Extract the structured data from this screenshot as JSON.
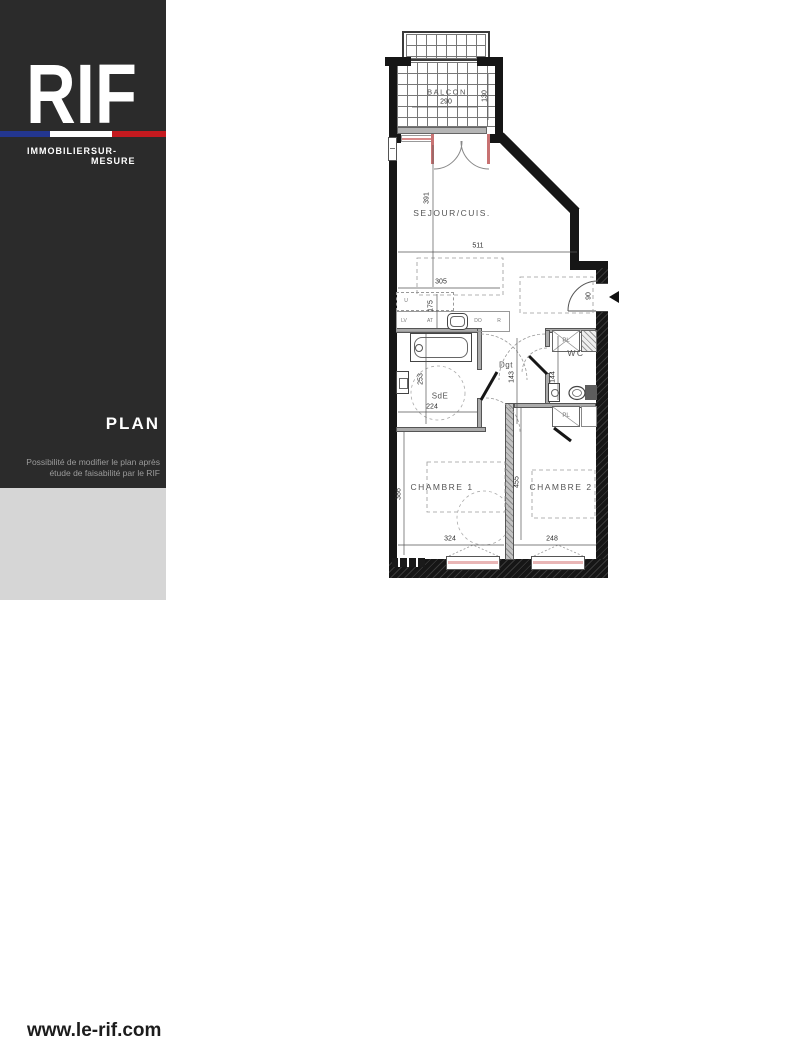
{
  "sidebar": {
    "logo": "RIF",
    "tagline_left": "IMMOBILIER",
    "tagline_right": "SUR-MESURE",
    "section_title": "PLAN",
    "note_line1": "Possibilité de modifier le plan après",
    "note_line2": "étude de faisabilité par le RIF",
    "website": "www.le-rif.com",
    "colors": {
      "background": "#2b2b2b",
      "footer_background": "#d6d6d6",
      "flag_blue": "#23368f",
      "flag_white": "#ffffff",
      "flag_red": "#c41a1f",
      "text": "#ffffff",
      "note_text": "#9b9b9b"
    }
  },
  "plan": {
    "rooms": {
      "balcon": "BALCON",
      "sejour": "SEJOUR/CUIS.",
      "sde": "SdE",
      "dgt": "Dgt",
      "wc": "WC",
      "chambre1": "CHAMBRE 1",
      "chambre2": "CHAMBRE 2",
      "placard": "PL"
    },
    "dims": {
      "balcon_w": "290",
      "balcon_d": "130",
      "sejour_h": "391",
      "sejour_w": "511",
      "kitchen_w": "305",
      "kitchen_d": "175",
      "sde_w": "224",
      "sde_h": "253",
      "dgt_h": "143",
      "wc_h": "144",
      "entree_w": "90",
      "ch1_w": "324",
      "ch1_h": "386",
      "ch2_w": "248",
      "ch2_h": "455"
    },
    "kitchen_labels": [
      "U",
      "LV",
      "AT",
      "DO",
      "R"
    ],
    "colors": {
      "wall": "#161616",
      "window_frame": "#c87272",
      "window_sill": "#e9b6b6",
      "balcony_sill": "#b5b5b5",
      "dashed_furniture": "#9a9a9a"
    }
  }
}
